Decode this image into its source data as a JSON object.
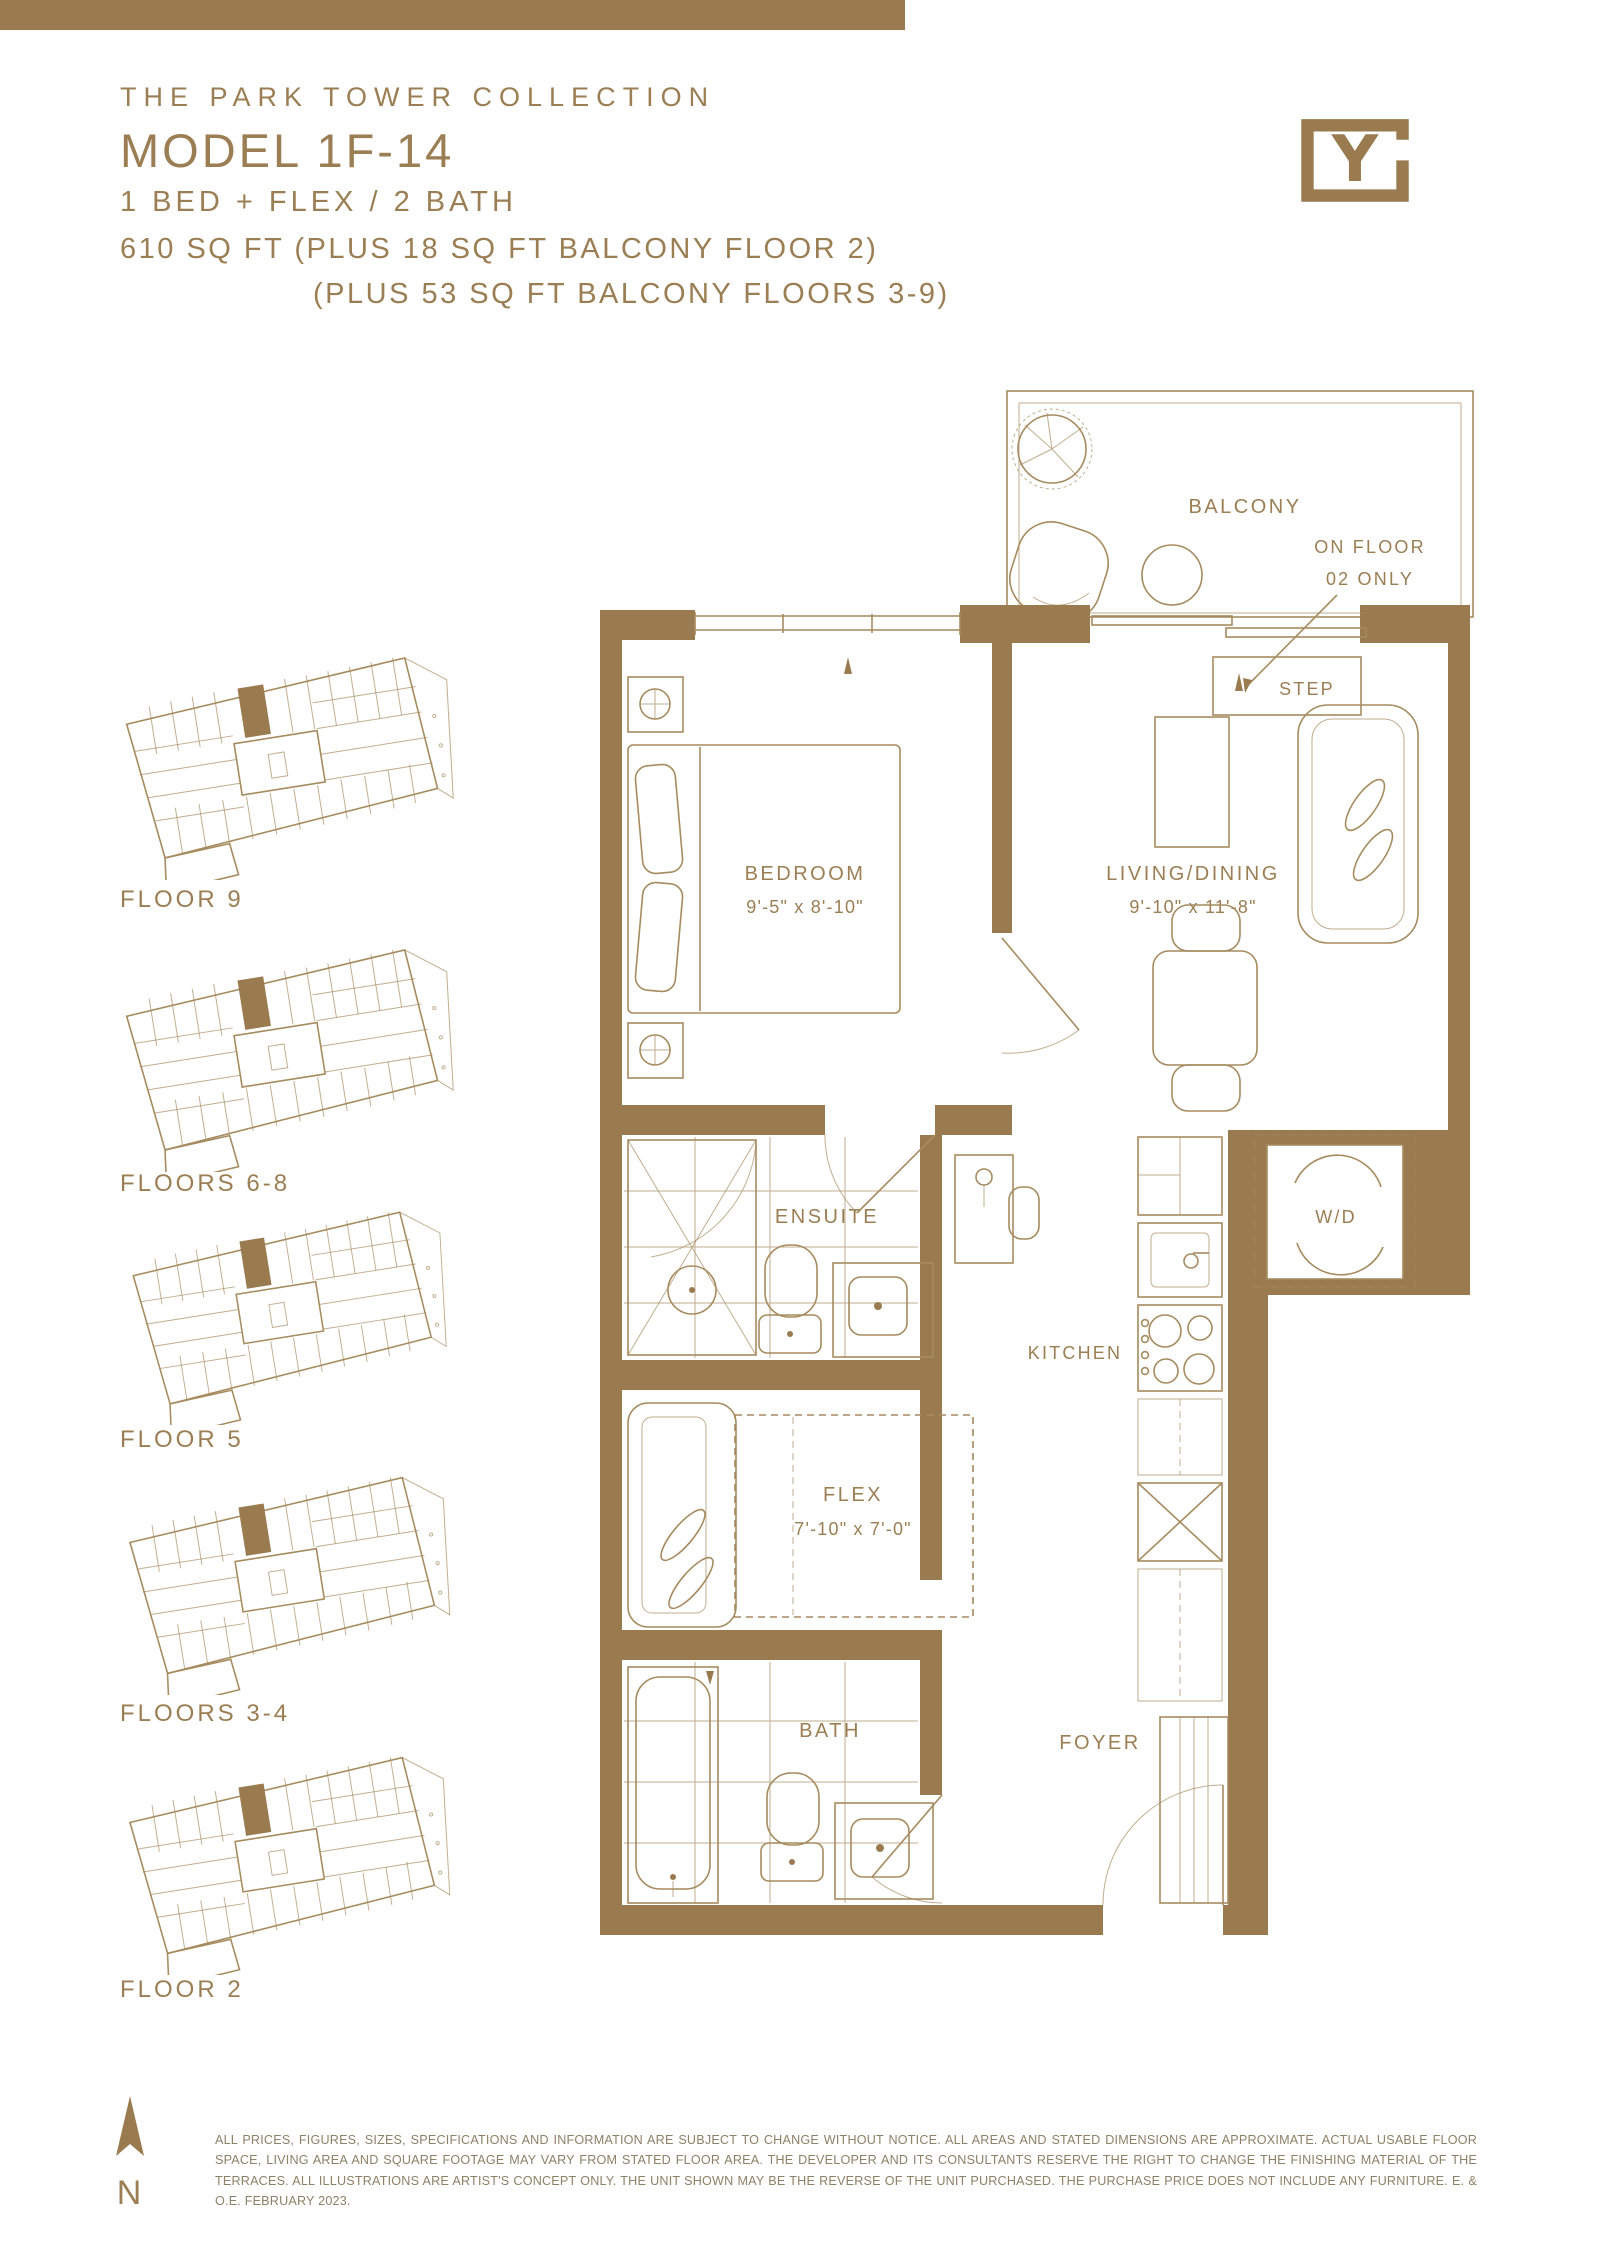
{
  "header": {
    "collection": "THE PARK TOWER COLLECTION",
    "model": "MODEL 1F-14",
    "config": "1 BED + FLEX / 2 BATH",
    "area_line1": "610 SQ FT (PLUS 18 SQ FT BALCONY FLOOR 2)",
    "area_line2": "(PLUS 53 SQ FT BALCONY FLOORS 3-9)"
  },
  "logo": {
    "letter": "Y"
  },
  "keyplans": [
    {
      "label": "FLOOR 9"
    },
    {
      "label": "FLOORS 6-8"
    },
    {
      "label": "FLOOR 5"
    },
    {
      "label": "FLOORS 3-4"
    },
    {
      "label": "FLOOR 2"
    }
  ],
  "plan": {
    "balcony": {
      "label": "BALCONY",
      "note1": "ON FLOOR",
      "note2": "02 ONLY",
      "step": "STEP"
    },
    "rooms": {
      "bedroom": {
        "name": "BEDROOM",
        "dims": "9'-5\" x 8'-10\""
      },
      "living": {
        "name": "LIVING/DINING",
        "dims": "9'-10\" x 11'-8\""
      },
      "ensuite": {
        "name": "ENSUITE"
      },
      "wd": {
        "name": "W/D"
      },
      "kitchen": {
        "name": "KITCHEN"
      },
      "flex": {
        "name": "FLEX",
        "dims": "7'-10\" x 7'-0\""
      },
      "bath": {
        "name": "BATH"
      },
      "foyer": {
        "name": "FOYER"
      }
    }
  },
  "compass": {
    "label": "N"
  },
  "footer": {
    "disclaimer": "ALL PRICES, FIGURES, SIZES, SPECIFICATIONS AND INFORMATION ARE SUBJECT TO CHANGE WITHOUT NOTICE. ALL AREAS AND STATED DIMENSIONS ARE APPROXIMATE. ACTUAL USABLE FLOOR SPACE, LIVING AREA AND SQUARE FOOTAGE MAY VARY FROM STATED FLOOR AREA. THE DEVELOPER AND ITS CONSULTANTS RESERVE THE RIGHT TO CHANGE THE FINISHING MATERIAL OF THE TERRACES. ALL ILLUSTRATIONS ARE ARTIST'S CONCEPT ONLY. THE UNIT SHOWN MAY BE THE REVERSE OF THE UNIT PURCHASED. THE PURCHASE PRICE DOES NOT INCLUDE ANY FURNITURE. E. & O.E. FEBRUARY 2023."
  },
  "colors": {
    "gold": "#9a7b50",
    "line": "#a68b5f",
    "text": "#9b7e53",
    "disclaimer": "#8d8167"
  }
}
